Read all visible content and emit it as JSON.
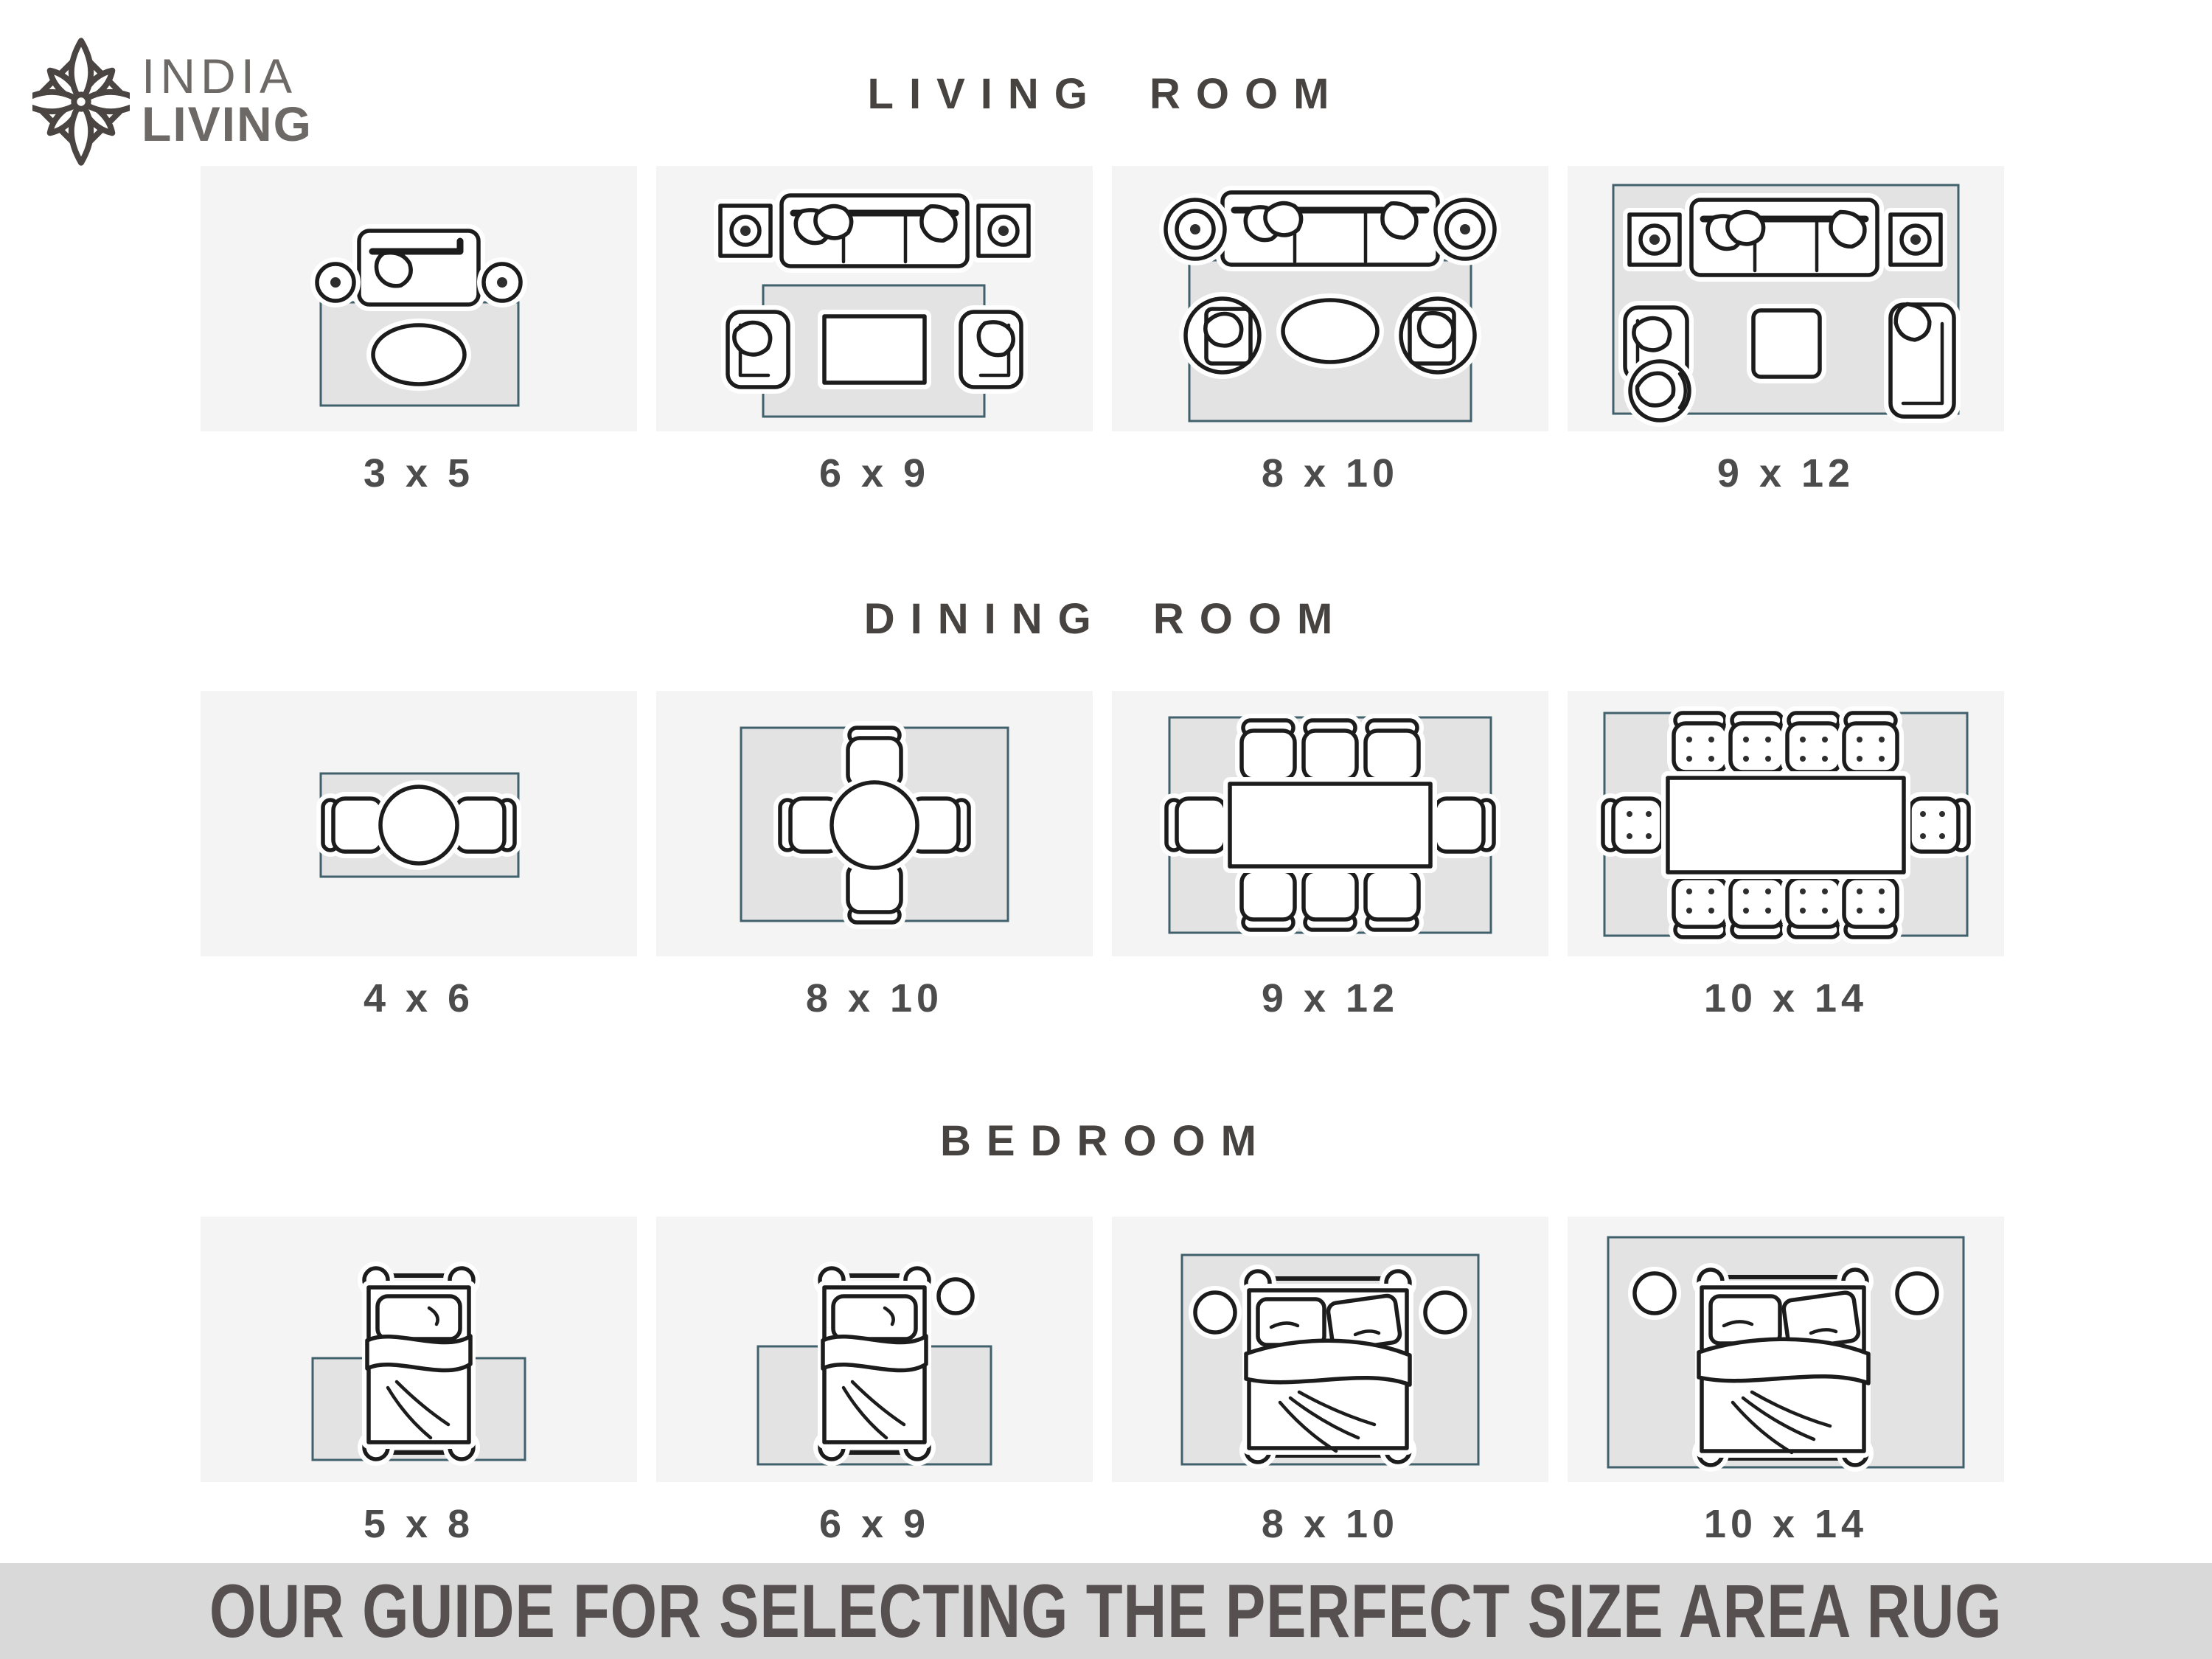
{
  "logo": {
    "icon": "lotus-flower-icon",
    "line1": "INDIA",
    "line2": "LIVING"
  },
  "sections": [
    {
      "title": "LIVING ROOM",
      "tiles": [
        {
          "size": "3 x 5",
          "scene": "loveseat-two-round-side-tables-oval-coffee-table-small-rug"
        },
        {
          "size": "6 x 9",
          "scene": "sofa-two-square-side-tables-two-armchairs-rect-coffee-table-rug"
        },
        {
          "size": "8 x 10",
          "scene": "sofa-two-round-side-tables-two-round-chairs-oval-coffee-table-rug"
        },
        {
          "size": "9 x 12",
          "scene": "sofa-speakers-armchair-round-chair-chaise-square-coffee-table-full-rug"
        }
      ]
    },
    {
      "title": "DINING ROOM",
      "tiles": [
        {
          "size": "4 x 6",
          "scene": "round-table-2-chairs-rug"
        },
        {
          "size": "8 x 10",
          "scene": "round-table-4-chairs-rug"
        },
        {
          "size": "9 x 12",
          "scene": "rect-table-8-chairs-rug"
        },
        {
          "size": "10 x 14",
          "scene": "rect-table-10-chairs-rug"
        }
      ]
    },
    {
      "title": "BEDROOM",
      "tiles": [
        {
          "size": "5 x 8",
          "scene": "single-bed-lower-rug"
        },
        {
          "size": "6 x 9",
          "scene": "single-bed-nightstand-lower-rug"
        },
        {
          "size": "8 x 10",
          "scene": "double-bed-two-nightstands-rug"
        },
        {
          "size": "10 x 14",
          "scene": "double-bed-two-nightstands-full-rug"
        }
      ]
    }
  ],
  "footer": {
    "text": "OUR GUIDE FOR SELECTING THE PERFECT SIZE AREA RUG"
  },
  "colors": {
    "tile_background": "#f4f4f4",
    "rug_fill": "#e3e3e4",
    "rug_border": "#40616b",
    "furniture_outline": "#1c1c1c",
    "label_text": "#4c4c4c",
    "title_text": "#474340",
    "banner_background": "#d9d9d9",
    "banner_text": "#575051",
    "logo_text": "#6d6966"
  }
}
